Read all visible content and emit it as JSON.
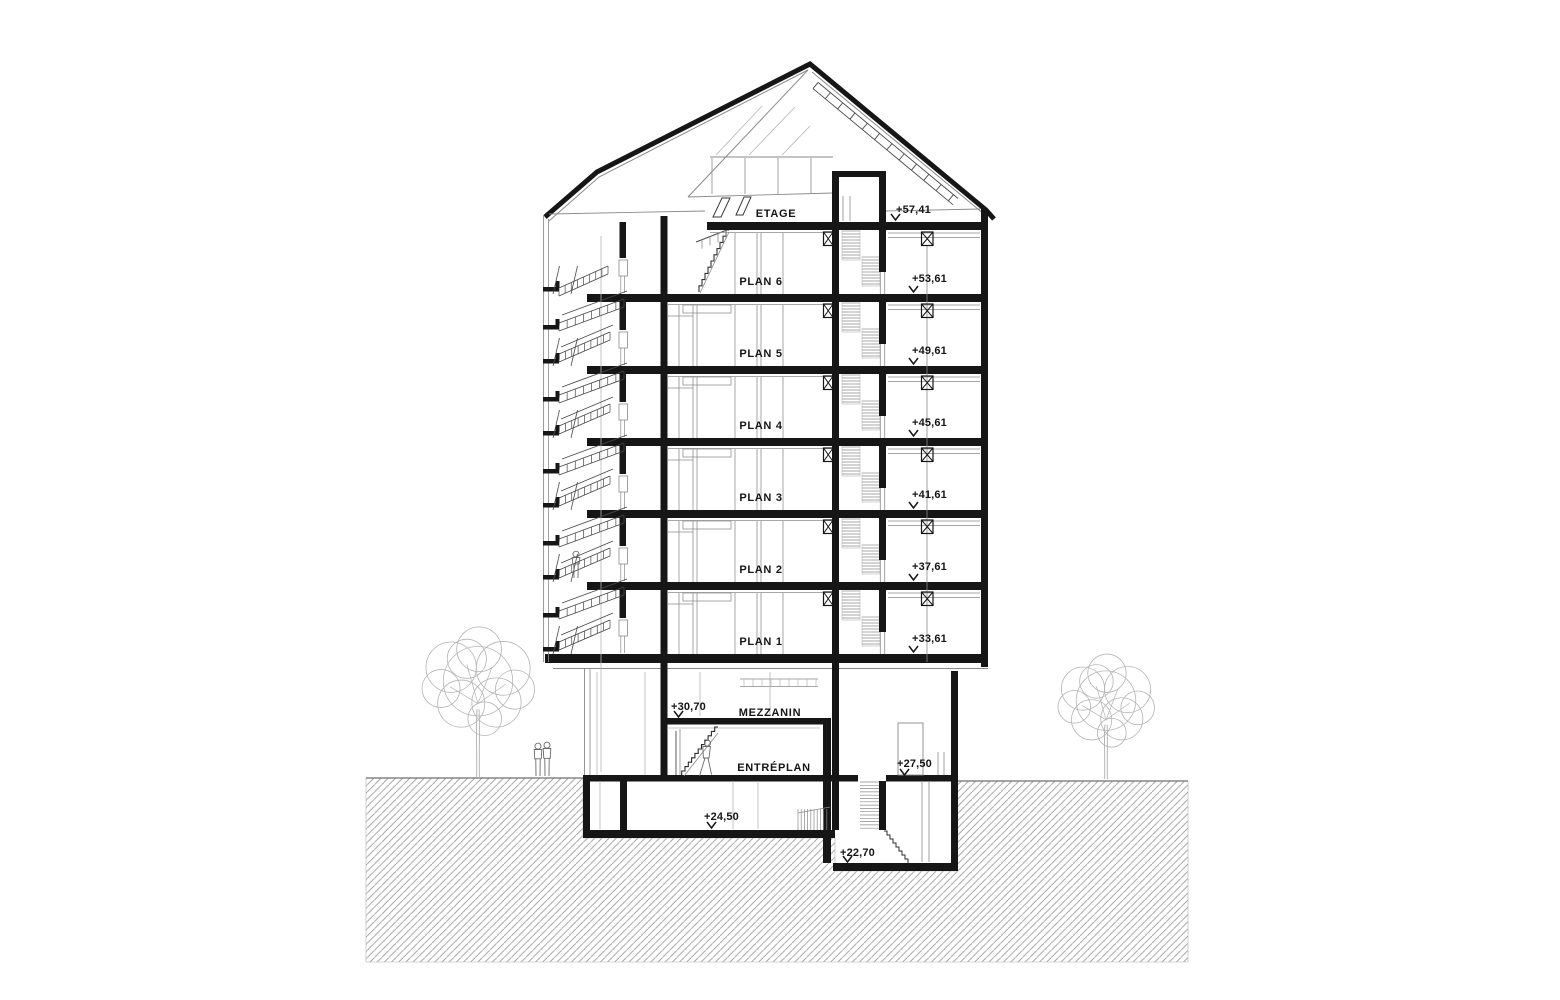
{
  "title": "Building cross-section drawing",
  "canvas": {
    "width": 1560,
    "height": 1000,
    "background": "#ffffff"
  },
  "colors": {
    "cut": "#161616",
    "medium": "#4a4a4a",
    "light": "#8a8a8a",
    "xlight": "#b5b5b5",
    "hatch": "#9a9a9a",
    "ground_edge": "#6f6f6f",
    "text": "#151515"
  },
  "levels": [
    {
      "label": "ETAGE",
      "elevation": "+57,41",
      "slab_y": 222,
      "label_x": 776,
      "label_y": 217,
      "elev_x": 896,
      "elev_y": 213,
      "marker_x": 891,
      "marker_y": 220
    },
    {
      "label": "PLAN 6",
      "elevation": "+53,61",
      "slab_y": 294,
      "label_x": 761,
      "label_y": 285,
      "elev_x": 912,
      "elev_y": 282,
      "marker_x": 909,
      "marker_y": 292
    },
    {
      "label": "PLAN 5",
      "elevation": "+49,61",
      "slab_y": 366,
      "label_x": 761,
      "label_y": 357,
      "elev_x": 912,
      "elev_y": 354,
      "marker_x": 909,
      "marker_y": 364
    },
    {
      "label": "PLAN 4",
      "elevation": "+45,61",
      "slab_y": 438,
      "label_x": 761,
      "label_y": 429,
      "elev_x": 912,
      "elev_y": 426,
      "marker_x": 909,
      "marker_y": 436
    },
    {
      "label": "PLAN 3",
      "elevation": "+41,61",
      "slab_y": 510,
      "label_x": 761,
      "label_y": 501,
      "elev_x": 912,
      "elev_y": 498,
      "marker_x": 909,
      "marker_y": 508
    },
    {
      "label": "PLAN 2",
      "elevation": "+37,61",
      "slab_y": 582,
      "label_x": 761,
      "label_y": 573,
      "elev_x": 912,
      "elev_y": 570,
      "marker_x": 909,
      "marker_y": 580
    },
    {
      "label": "PLAN 1",
      "elevation": "+33,61",
      "slab_y": 654,
      "label_x": 761,
      "label_y": 645,
      "elev_x": 912,
      "elev_y": 642,
      "marker_x": 909,
      "marker_y": 652
    },
    {
      "label": "MEZZANIN",
      "elevation": "+30,70",
      "slab_y": 718,
      "label_x": 770,
      "label_y": 716,
      "elev_x": 671,
      "elev_y": 710,
      "marker_x": 674,
      "marker_y": 717
    },
    {
      "label": "ENTRÉPLAN",
      "elevation": "+27,50",
      "slab_y": 777,
      "label_x": 774,
      "label_y": 771,
      "elev_x": 897,
      "elev_y": 767,
      "marker_x": 900,
      "marker_y": 775
    },
    {
      "label": "",
      "elevation": "+24,50",
      "slab_y": 830,
      "label_x": 0,
      "label_y": 0,
      "elev_x": 704,
      "elev_y": 820,
      "marker_x": 707,
      "marker_y": 828
    },
    {
      "label": "",
      "elevation": "+22,70",
      "slab_y": 863,
      "label_x": 0,
      "label_y": 0,
      "elev_x": 840,
      "elev_y": 856,
      "marker_x": 843,
      "marker_y": 862
    }
  ],
  "site": {
    "trees": [
      {
        "cx": 478,
        "ground_y": 777,
        "canopy_cy": 684,
        "radius": 56
      },
      {
        "cx": 1106,
        "ground_y": 779,
        "canopy_cy": 703,
        "radius": 48
      }
    ],
    "people": [
      {
        "type": "standing",
        "x": 538,
        "y": 776,
        "h": 33
      },
      {
        "type": "standing",
        "x": 547,
        "y": 776,
        "h": 34
      },
      {
        "type": "standing",
        "x": 576,
        "y": 578,
        "h": 27
      },
      {
        "type": "walking",
        "x": 706,
        "y": 776,
        "h": 36
      }
    ]
  }
}
